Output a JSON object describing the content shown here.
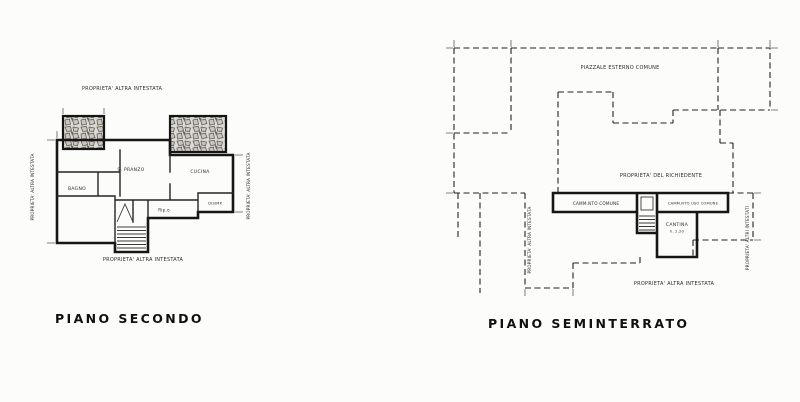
{
  "plans": {
    "secondo": {
      "title": "PIANO SECONDO",
      "labels": {
        "top": "PROPRIETA' ALTRA INTESTATA",
        "bottom": "PROPRIETA' ALTRA INTESTATA",
        "left": "PROPRIETA' ALTRA INTESTATA",
        "right": "PROPRIETA' ALTRA INTESTATA"
      },
      "rooms": {
        "pranzo": "S. PRANZO",
        "cucina": "CUCINA",
        "bagno": "BAGNO",
        "rip": "Rip.o",
        "disimpegno": "DISIMP."
      }
    },
    "seminterrato": {
      "title": "PIANO SEMINTERRATO",
      "labels": {
        "top": "PIAZZALE ESTERNO COMUNE",
        "middle": "PROPRIETA' DEL RICHIEDENTE",
        "bottom": "PROPRIETA' ALTRA INTESTATA",
        "left": "PROPRIETA' ALTRA INTESTATA",
        "right": "PROPRIETA' ALTRI INTESTATI",
        "corridor_left": "CAMM.NTO COMUNE",
        "corridor_right": "CAMM.NTO USO COMUNE"
      },
      "rooms": {
        "cantina": "CANTINA",
        "cantina_height": "h. 2.20"
      }
    }
  },
  "colors": {
    "ink": "#1c1c1c",
    "paper": "#fcfcfb",
    "stone_fill": "#d9d6d0"
  }
}
